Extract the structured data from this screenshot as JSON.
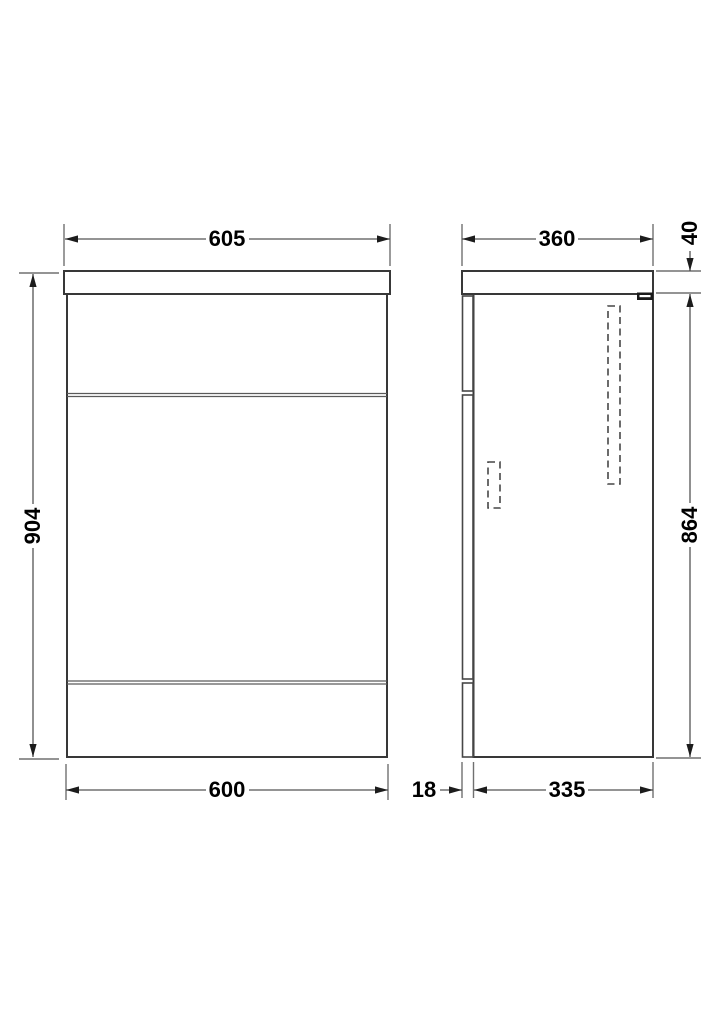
{
  "drawing": {
    "type": "furniture-dimension-drawing",
    "views": [
      "front-elevation",
      "side-elevation"
    ],
    "colors": {
      "background": "#ffffff",
      "line": "#383838",
      "dimension_text": "#000000"
    }
  },
  "dimensions": {
    "front_width_top": "605",
    "front_height": "904",
    "front_width_bottom": "600",
    "side_depth_top": "360",
    "side_worktop_thickness": "40",
    "side_cabinet_height": "864",
    "side_front_panel_thickness": "18",
    "side_cabinet_depth": "335"
  }
}
